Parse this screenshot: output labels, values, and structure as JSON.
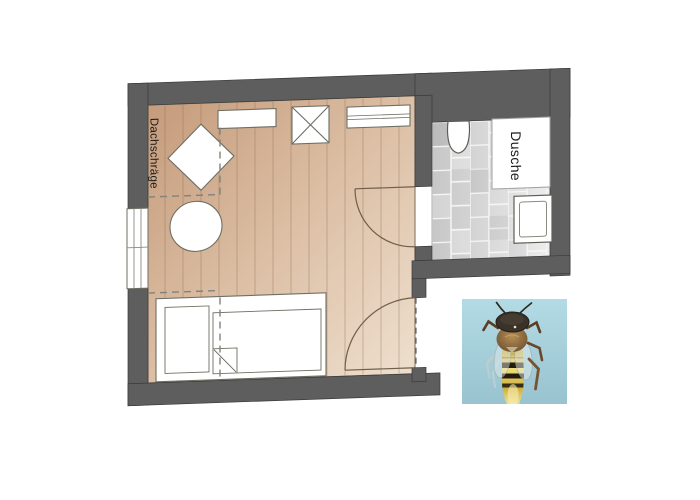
{
  "floorplan": {
    "labels": {
      "sloped_roof": "Dachschräge",
      "shower": "Dusche"
    },
    "colors": {
      "wall": "#5e5e5e",
      "wall_edge": "#3a3a3a",
      "floor_dark": "#c59b7b",
      "floor_mid": "#dcbfa5",
      "floor_light": "#eedfce",
      "plank_line": "#8f6c4c",
      "tile_dark": "#c6c6c6",
      "tile_light": "#ededed",
      "grout": "#f7f7f7",
      "furniture_fill": "#ffffff",
      "furniture_stroke": "#6e6e64",
      "door_line": "#6f5f4a",
      "dashed_line": "#82827a",
      "label_text": "#1b1b1b"
    }
  },
  "bee_photo": {
    "colors": {
      "background_top": "#b3dbe5",
      "background_bottom": "#98c3cf",
      "head": "#3a332a",
      "thorax_center": "#b58e54",
      "thorax_edge": "#6a4d2e",
      "gold_dark": "#bb9c38",
      "gold_light": "#eedd7d",
      "band": "#241e10",
      "wing": "#e4ebeb",
      "leg": "#5c3d24"
    }
  }
}
